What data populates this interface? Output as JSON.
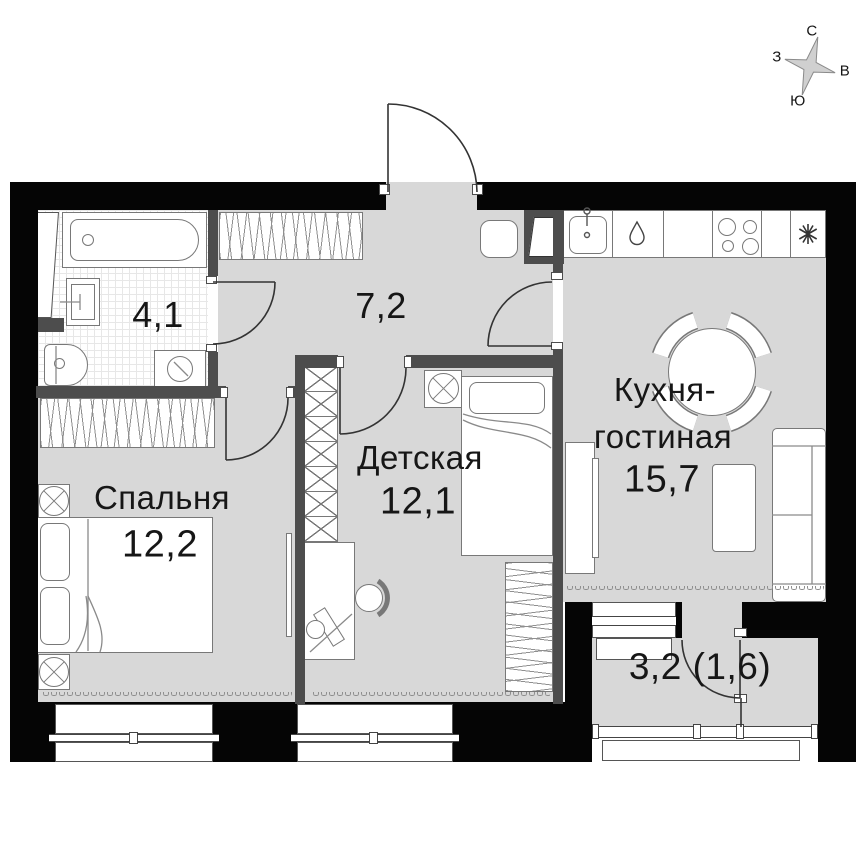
{
  "compass": {
    "north": "С",
    "east": "В",
    "south": "Ю",
    "west": "З"
  },
  "rooms": {
    "bathroom": {
      "area": "4,1"
    },
    "hallway": {
      "area": "7,2"
    },
    "bedroom": {
      "name": "Спальня",
      "area": "12,2"
    },
    "children_room": {
      "name": "Детская",
      "area": "12,1"
    },
    "kitchen_living": {
      "name_line1": "Кухня-",
      "name_line2": "гостиная",
      "area": "15,7"
    },
    "balcony": {
      "area": "3,2 (1,6)"
    }
  },
  "icons": {
    "kitchen_fixtures": [
      "sink-icon",
      "dishwasher-drop-icon",
      "stove-burners-icon",
      "refrigerator-snowflake-icon"
    ],
    "bathroom_fixtures": [
      "bathtub-icon",
      "washbasin-icon",
      "toilet-icon",
      "washing-machine-icon",
      "vent-shaft-icon"
    ],
    "furniture": [
      "double-bed",
      "single-bed",
      "nightstand-lamp",
      "wardrobe-hangers",
      "wardrobe-shelves",
      "desk",
      "desk-chair",
      "dining-table",
      "dining-chair",
      "sofa",
      "coffee-table",
      "tv-stand",
      "entrance-pouf"
    ]
  },
  "colors": {
    "wall": "#050505",
    "inner_wall": "#4d4d4d",
    "floor": "#d8d8d8",
    "line": "#787878"
  }
}
